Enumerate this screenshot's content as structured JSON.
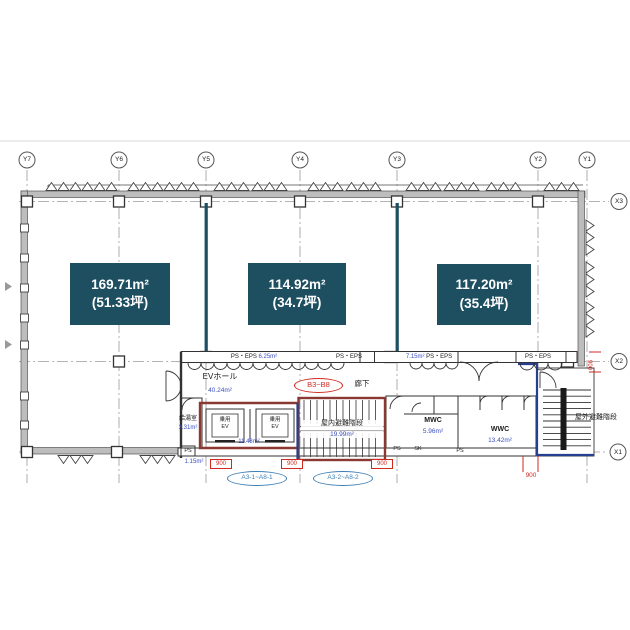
{
  "plan": {
    "grid": {
      "y_labels": [
        "Y7",
        "Y6",
        "Y5",
        "Y4",
        "Y3",
        "Y2",
        "Y1"
      ],
      "x_labels": [
        "X3",
        "X2",
        "X1"
      ]
    },
    "units": [
      {
        "area": "169.71m²",
        "tsubo": "(51.33坪)"
      },
      {
        "area": "114.92m²",
        "tsubo": "(34.7坪)"
      },
      {
        "area": "117.20m²",
        "tsubo": "(35.4坪)"
      }
    ],
    "shafts": {
      "left": {
        "name": "PS・EPS",
        "area": "6.25m²"
      },
      "mid": {
        "name": "PS・EPS"
      },
      "mid2": {
        "area": "7.15m²",
        "name": "PS・EPS"
      },
      "right": {
        "name": "PS・EPS"
      }
    },
    "rooms": {
      "ev_hall": {
        "name": "EVホール",
        "area": "40.24m²"
      },
      "corridor": {
        "name": "廊下"
      },
      "kitchen": {
        "name": "給湯室",
        "area": "3.31m²"
      },
      "elevator": {
        "line1": "乗用",
        "line2": "EV"
      },
      "elevators_area": "11.48m²",
      "indoor_stair": {
        "name": "屋内避難階段",
        "area": "19.99m²"
      },
      "outdoor_stair": {
        "name": "屋外避難階段"
      },
      "mwc": {
        "name": "MWC",
        "area": "5.96m²"
      },
      "wwc": {
        "name": "WWC",
        "area": "13.42m²"
      },
      "ps1": "PS",
      "ps2": "PS",
      "ps3": "PS",
      "sk": "SK",
      "ps_area": "1.15m²"
    },
    "tags": {
      "b_range": "B3~B8",
      "a_range_1": "A3-1~A8-1",
      "a_range_2": "A3-2~A8-2"
    },
    "dims": {
      "d1": "900",
      "d2": "900",
      "d3": "900",
      "d4": "900",
      "d5": "900"
    },
    "colors": {
      "unit_box": "#1e4f61",
      "accent_red": "#d02a20",
      "accent_blue": "#3a4fc0",
      "tag_blue": "#3f7fb5",
      "maroon": "#8a3832",
      "navy": "#24408e"
    }
  }
}
